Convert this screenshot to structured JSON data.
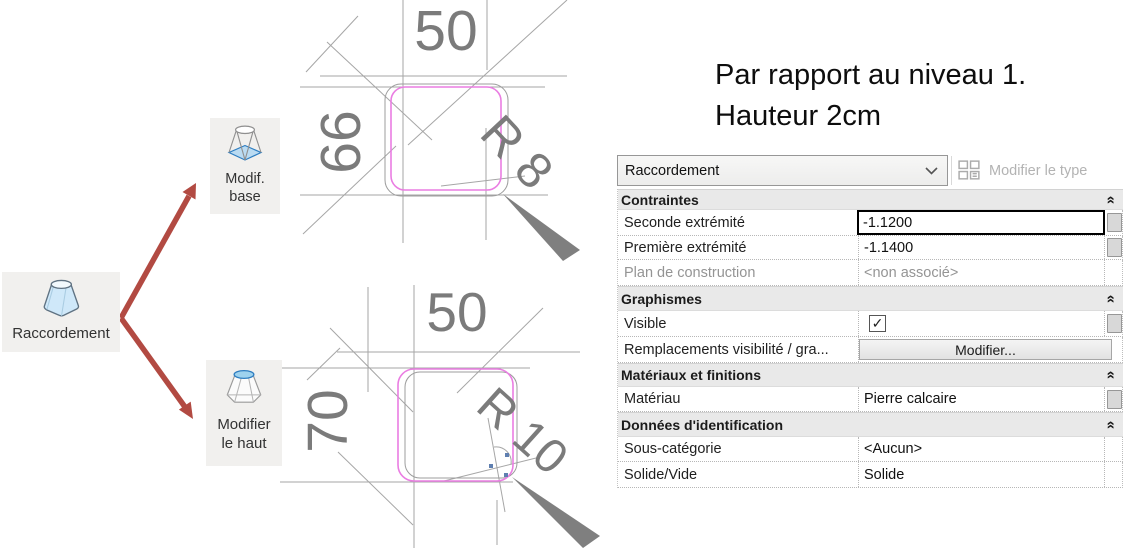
{
  "tools": {
    "source": {
      "label": "Raccordement"
    },
    "modif_base": {
      "line1": "Modif.",
      "line2": "base"
    },
    "modifier_haut": {
      "line1": "Modifier",
      "line2": "le haut"
    }
  },
  "sketches": {
    "top": {
      "width_dim": "50",
      "height_dim": "66",
      "radius_dim": "R 8"
    },
    "bottom": {
      "width_dim": "50",
      "height_dim": "70",
      "radius_dim": "R 10"
    }
  },
  "note": {
    "line1": "Par rapport au niveau 1.",
    "line2": "Hauteur 2cm"
  },
  "panel": {
    "type_selector": "Raccordement",
    "edit_type_label": "Modifier le type",
    "groups": {
      "contraintes": "Contraintes",
      "graphismes": "Graphismes",
      "materiaux": "Matériaux et finitions",
      "donnees": "Données d'identification"
    },
    "rows": {
      "seconde": {
        "label": "Seconde extrémité",
        "value": "-1.1200"
      },
      "premiere": {
        "label": "Première extrémité",
        "value": "-1.1400"
      },
      "plan": {
        "label": "Plan de construction",
        "value": "<non associé>"
      },
      "visible": {
        "label": "Visible",
        "checked": "true"
      },
      "remplacements": {
        "label": "Remplacements visibilité / gra...",
        "button": "Modifier..."
      },
      "materiau": {
        "label": "Matériau",
        "value": "Pierre calcaire"
      },
      "sous_categorie": {
        "label": "Sous-catégorie",
        "value": "<Aucun>"
      },
      "solide": {
        "label": "Solide/Vide",
        "value": "Solide"
      }
    }
  },
  "colors": {
    "arrow_red": "#b24a42",
    "sketch_pink": "#ea7de2",
    "sketch_gray": "#a6a6a6",
    "dim_gray": "#7b7b7b",
    "wedge_gray": "#7f7f7f"
  }
}
